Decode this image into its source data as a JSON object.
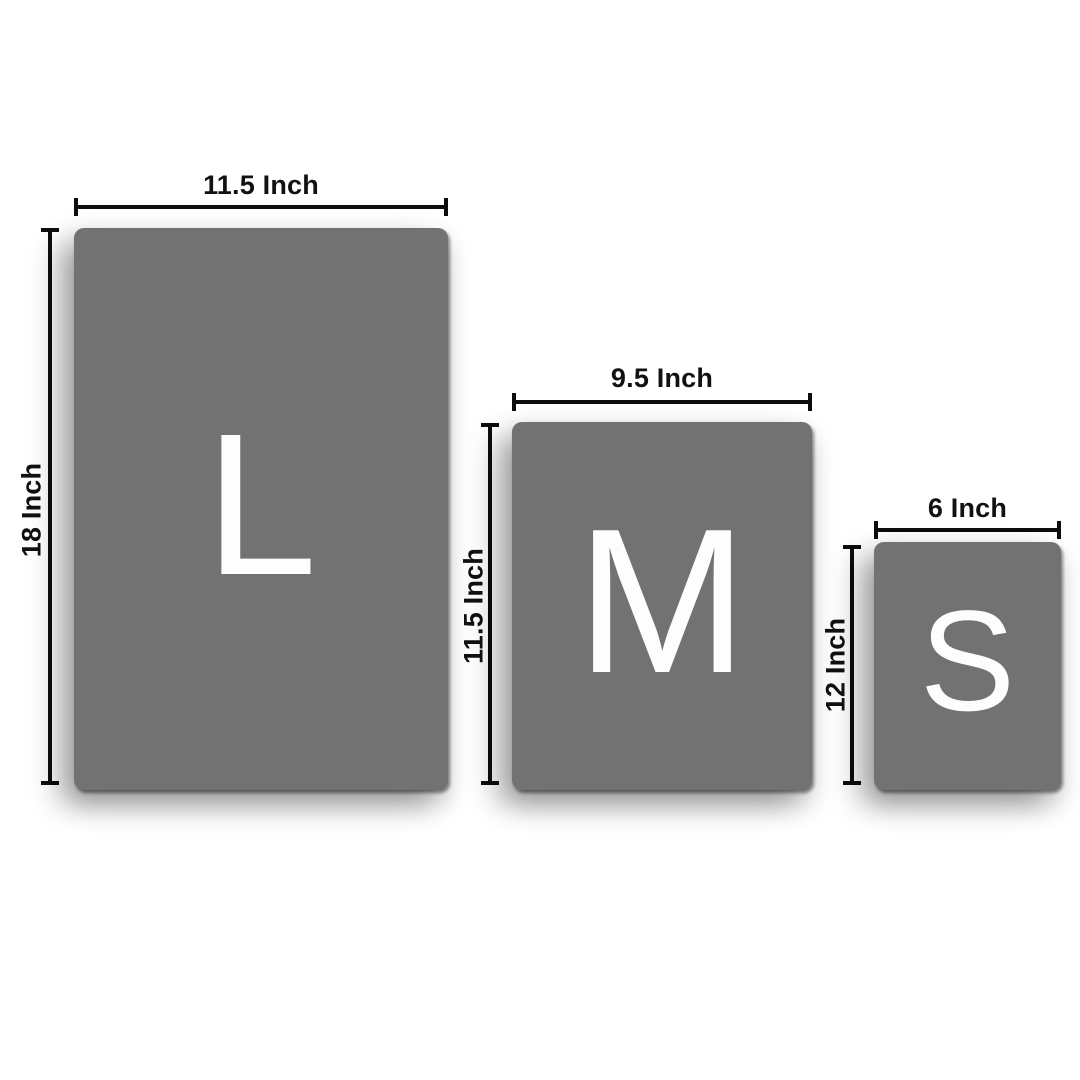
{
  "diagram": {
    "colors": {
      "background": "#ffffff",
      "card": "#727272",
      "letter": "#fdfdfd",
      "dimension_line": "#0d0d0d",
      "label_text": "#111111"
    },
    "unit": "Inch",
    "sizes": [
      {
        "letter": "L",
        "width_label": "11.5 Inch",
        "height_label": "18 Inch",
        "width_inches": 11.5,
        "height_inches": 18
      },
      {
        "letter": "M",
        "width_label": "9.5 Inch",
        "height_label": "11.5 Inch",
        "width_inches": 9.5,
        "height_inches": 11.5
      },
      {
        "letter": "S",
        "width_label": "6 Inch",
        "height_label": "12 Inch",
        "width_inches": 6,
        "height_inches": 12
      }
    ]
  }
}
